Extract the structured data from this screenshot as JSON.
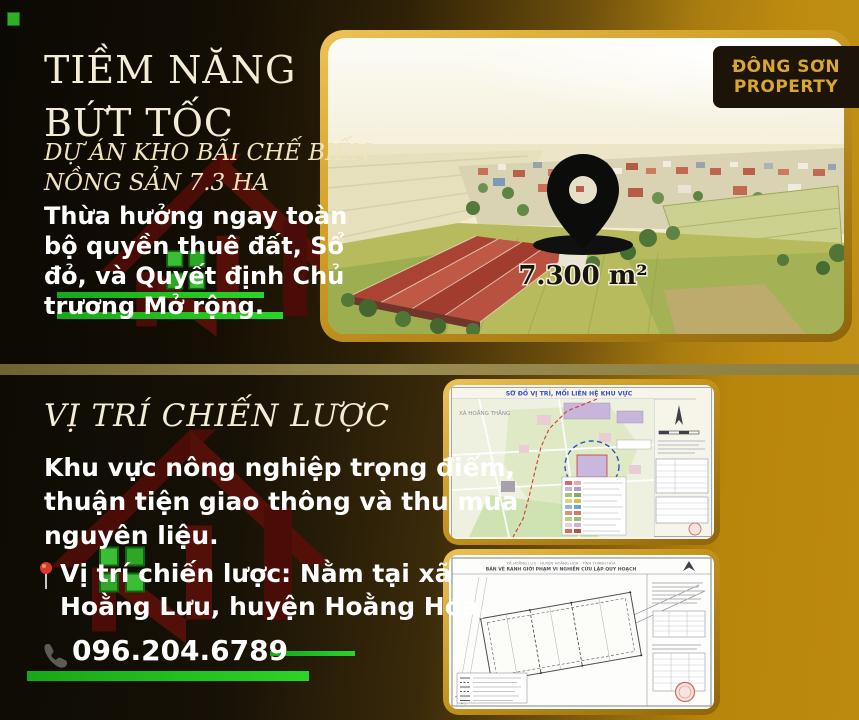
{
  "brand": {
    "name_line1": "ĐÔNG SƠN",
    "name_line2": "PROPERTY"
  },
  "hero": {
    "title_line1": "TIỀM NĂNG",
    "title_line2": "BỨT TỐC",
    "subtitle_line1": "DỰ ÁN KHO BÃI CHẾ BIẾN",
    "subtitle_line2": "NỒNG SẢN 7.3 HA",
    "body_line1": "Thừa hưởng ngay toàn",
    "body_line2": "bộ quyền thuê đất, Sổ",
    "body_line3": "đỏ, và Quyết định Chủ",
    "body_line4": "trương Mở rộng.",
    "photo": {
      "area_label": "7.300 m²"
    }
  },
  "location": {
    "title": "VỊ TRÍ CHIẾN LƯỢC",
    "body_line1": "Khu vực nông nghiệp trọng điểm,",
    "body_line2": "thuận tiện giao thông và thu mua",
    "body_line3": "nguyên liệu.",
    "pin_line1": "Vị trí chiến lược: Nằm tại xã",
    "pin_line2": "Hoằng Lưu, huyện Hoằng Hóa,",
    "phone": "096.204.6789"
  },
  "maps": {
    "map1": {
      "title": "SƠ ĐỒ VỊ TRÍ, MỐI LIÊN HỆ KHU VỰC",
      "label_left": "XÃ HOẰNG THẮNG"
    },
    "map2": {
      "title_line1": "XÃ HOẰNG LƯU - HUYỆN HOẰNG HÓA - TỈNH THANH HÓA",
      "title_line2": "BẢN VẼ RANH GIỚI PHẠM VI NGHIÊN CỨU LẬP QUY HOẠCH"
    }
  },
  "colors": {
    "accent_green": "#22c41e",
    "gold": "#bd8a10",
    "badge_bg": "#1c1309",
    "badge_text": "#d9a62e",
    "logo_red": "#4c0c07"
  }
}
